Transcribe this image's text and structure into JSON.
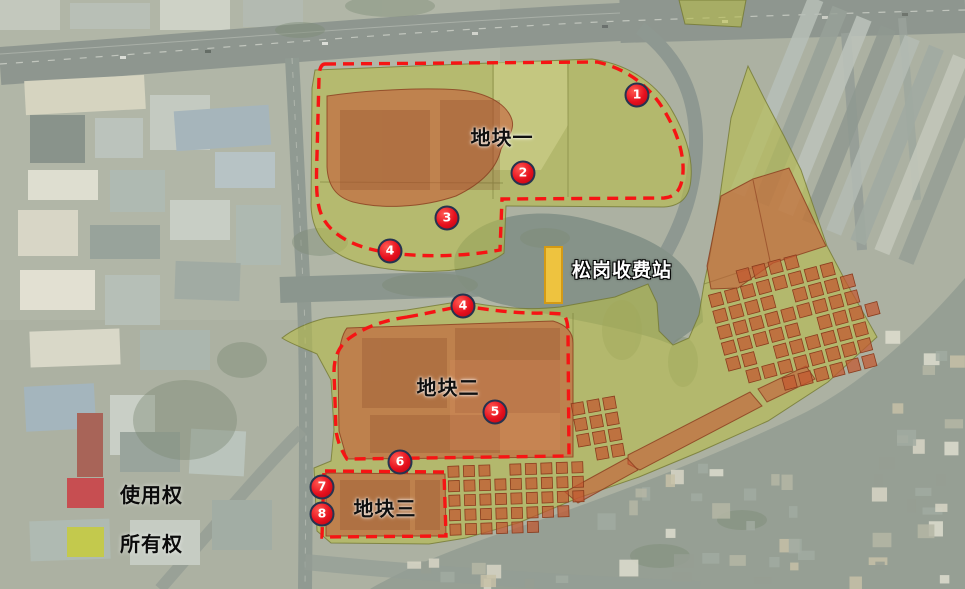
{
  "map": {
    "parcels": [
      {
        "label": "地块一",
        "x": 502,
        "y": 136
      },
      {
        "label": "地块二",
        "x": 448,
        "y": 386
      },
      {
        "label": "地块三",
        "x": 385,
        "y": 507
      }
    ],
    "station": {
      "label": "松岗收费站",
      "x": 572,
      "y": 269
    },
    "markers": [
      {
        "n": "1",
        "x": 637,
        "y": 95
      },
      {
        "n": "2",
        "x": 523,
        "y": 173
      },
      {
        "n": "3",
        "x": 447,
        "y": 218
      },
      {
        "n": "4",
        "x": 390,
        "y": 251
      },
      {
        "n": "4",
        "x": 463,
        "y": 306
      },
      {
        "n": "5",
        "x": 495,
        "y": 412
      },
      {
        "n": "6",
        "x": 400,
        "y": 462
      },
      {
        "n": "7",
        "x": 322,
        "y": 487
      },
      {
        "n": "8",
        "x": 322,
        "y": 514
      }
    ]
  },
  "legend": {
    "items": [
      {
        "label": "使用权",
        "color": "#cb4046"
      },
      {
        "label": "所有权",
        "color": "#c6cb3f"
      }
    ]
  },
  "colors": {
    "ownership_overlay": "#b7bd4a",
    "usage_overlay": "#c75333",
    "usage_square": "#c2572f",
    "boundary_dash": "#f61414",
    "station_fill": "#eec33f",
    "station_border": "#d49a15",
    "marker_fill": "#e6101e",
    "marker_border": "#26334f"
  }
}
